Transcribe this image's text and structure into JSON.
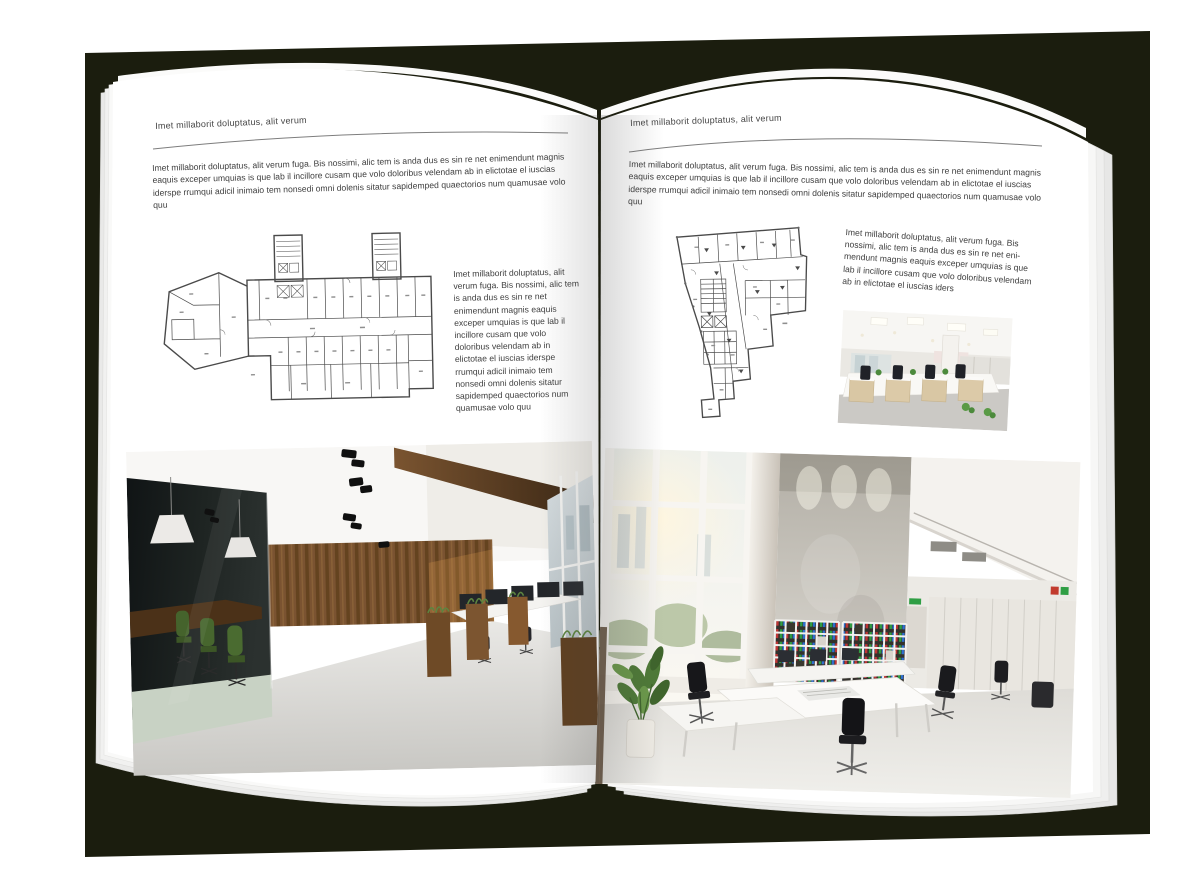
{
  "spread": {
    "type": "brochure-open-spread-mockup",
    "colors": {
      "backdrop": "#1b1d0e",
      "page": "#ffffff",
      "text": "#3e3e3e",
      "rule": "#7d7d7d",
      "plan_line": "#4a4a4a",
      "binder_green": "#2f9e44",
      "binder_blue": "#2e6fd0",
      "binder_red": "#c03535"
    }
  },
  "left_page": {
    "header": "Imet millaborit doluptatus, alit verum",
    "intro": "Imet millaborit doluptatus, alit verum fuga. Bis nossimi, alic tem is anda dus es sin re net enimendunt magnis eaquis exceper umquias is que lab il incillore cusam que volo doloribus velendam ab in elictotae el iuscias iderspe rrumqui adicil inimaio tem nonsedi omni dolenis sitatur sapidemped quaectorios num quamusae volo quu",
    "column_text": "Imet millaborit doluptatus, alit verum fuga. Bis nossimi, alic tem is anda dus es sin re net enimendunt magnis eaquis exceper umquias is que lab il incillore cusam que volo doloribus velendam ab in elictotae el iuscias iderspe rrumqui adicil inimaio tem nonsedi omni dolenis sitatur sapidemped quaectorios num quamusae volo quu",
    "floor_plan_name": "rectangular-office-building-floor-plan",
    "photo_name": "office-interior-dark-wood-wall-glass-meeting-room"
  },
  "right_page": {
    "header": "Imet millaborit doluptatus, alit verum",
    "intro": "Imet millaborit doluptatus, alit verum fuga. Bis nossimi, alic tem is anda dus es sin re net enimendunt magnis eaquis exceper umquias is que lab il incillore cusam que volo doloribus velendam ab in elictotae el iuscias iderspe rrumqui adicil inimaio tem nonsedi omni dolenis sitatur sapidemped quaectorios num quamusae volo quu",
    "column_text": "Imet millaborit doluptatus, alit verum fuga. Bis nossimi, alic tem is anda dus es sin re net eni- mendunt magnis eaquis exceper umquias is que lab il incillore cusam que volo doloribus velendam ab in elictotae el iuscias iders",
    "floor_plan_name": "irregular-office-building-floor-plan",
    "photo_small_name": "open-plan-office-rows-of-desks",
    "photo_name": "bright-double-height-office-atrium"
  }
}
